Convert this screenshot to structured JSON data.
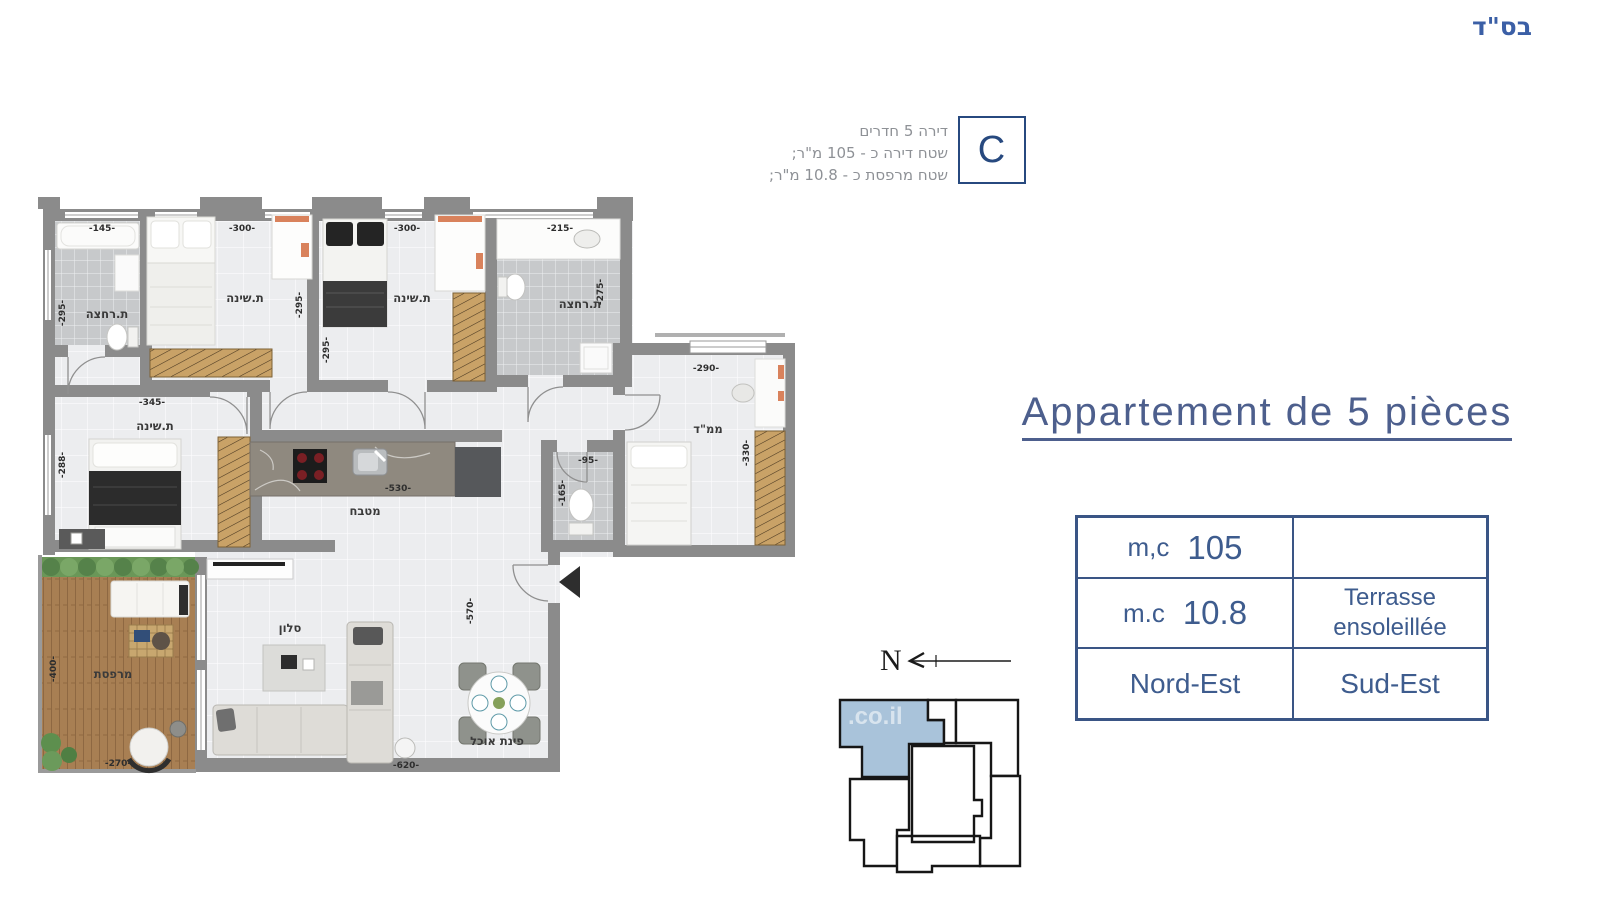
{
  "header": {
    "bsd": "בס\"ד",
    "badge_letter": "C",
    "info_line1": "דירה 5 חדרים",
    "info_line2": "שטח דירה כ - 105 מ\"ר;",
    "info_line3": "שטח מרפסת כ - 10.8 מ\"ר;"
  },
  "title": "Appartement de 5 pièces",
  "spec_table": {
    "area_label": "m,c",
    "area_value": "105",
    "area_note": "",
    "terrace_label": "m.c",
    "terrace_value": "10.8",
    "terrace_note_line1": "Terrasse",
    "terrace_note_line2": "ensoleillée",
    "orientation_left": "Nord-Est",
    "orientation_right": "Sud-Est"
  },
  "compass": {
    "north_label": "N"
  },
  "keyplan": {
    "watermark": ".co.il"
  },
  "plan": {
    "labels": {
      "bath1": "ת.רחצה",
      "bed1": "ת.שינה",
      "bed2": "ת.שינה",
      "bath2": "ת.רחצה",
      "mamad": "ממ\"ד",
      "bed3": "ת.שינה",
      "kitchen": "מטבח",
      "salon": "סלון",
      "dining": "פינת אוכל",
      "terrace": "מרפסת"
    },
    "dims": {
      "bath1_w": "-145-",
      "bath1_h": "-295-",
      "bed1_w": "-300-",
      "bed1_h": "-295-",
      "bed2_w": "-300-",
      "bed2_h": "-295-",
      "bath2_w": "-215-",
      "bath2_h": "-275-",
      "bed3_w": "-345-",
      "bed3_h": "-288-",
      "mamad_w": "-290-",
      "mamad_h": "-330-",
      "kitchen_w": "-530-",
      "wc_w": "-95-",
      "wc_h": "-165-",
      "salon_h": "-570-",
      "salon_w": "-620-",
      "terrace_h": "-400-",
      "terrace_w": "-270-"
    }
  },
  "colors": {
    "accent_blue": "#3e5c8e",
    "title_blue": "#4d5f8d",
    "highlight_unit": "#a9c3da",
    "wall_gray": "#8b8b8b"
  }
}
